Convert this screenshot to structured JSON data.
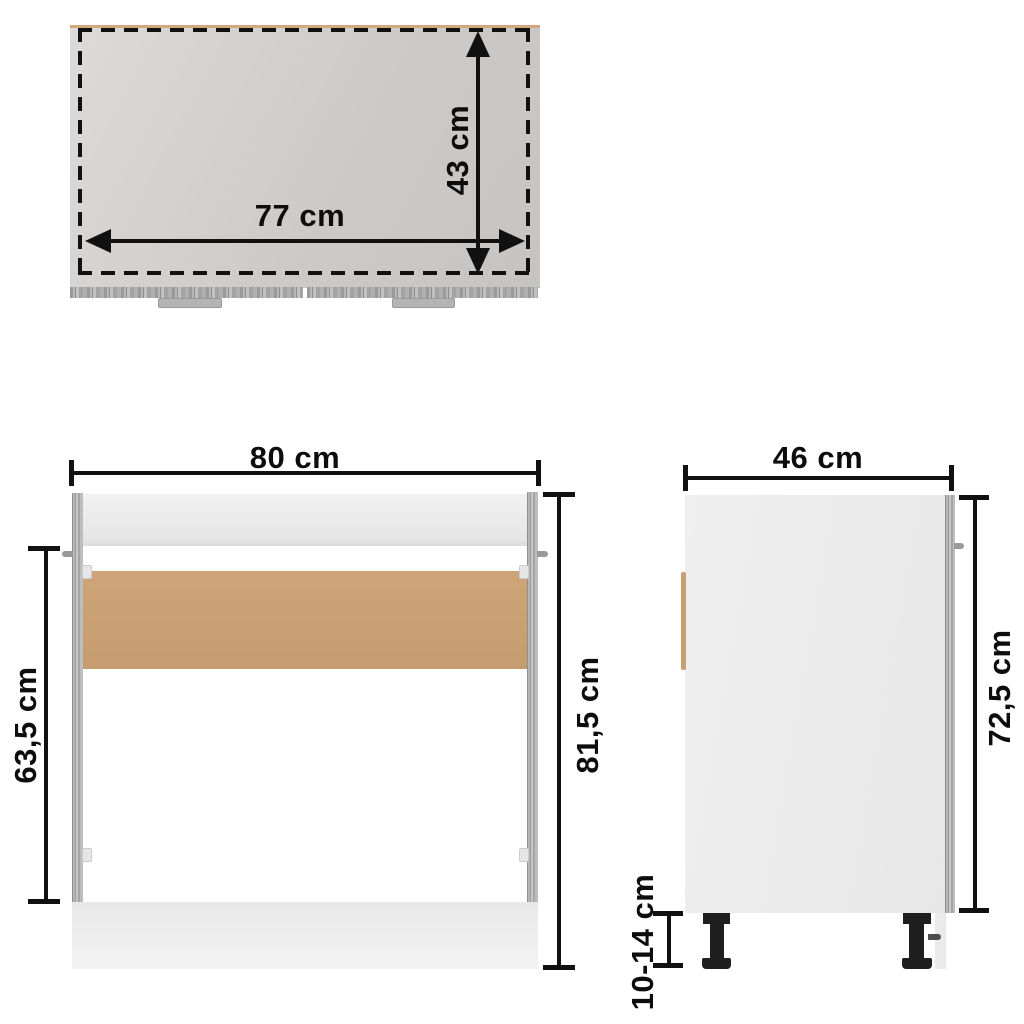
{
  "diagram_title": "sink base cabinet dimension diagram",
  "colors": {
    "ink": "#111111",
    "board_tan": "#c9a076",
    "wood_gray": "#a8a8a8",
    "leg_black": "#1f1f1f"
  },
  "top_view": {
    "width": "77 cm",
    "depth": "43 cm"
  },
  "front_view": {
    "width": "80 cm",
    "opening_height": "63,5 cm",
    "total_height": "81,5 cm"
  },
  "side_view": {
    "depth": "46 cm",
    "body_height": "72,5 cm",
    "leg_height": "10-14 cm"
  }
}
